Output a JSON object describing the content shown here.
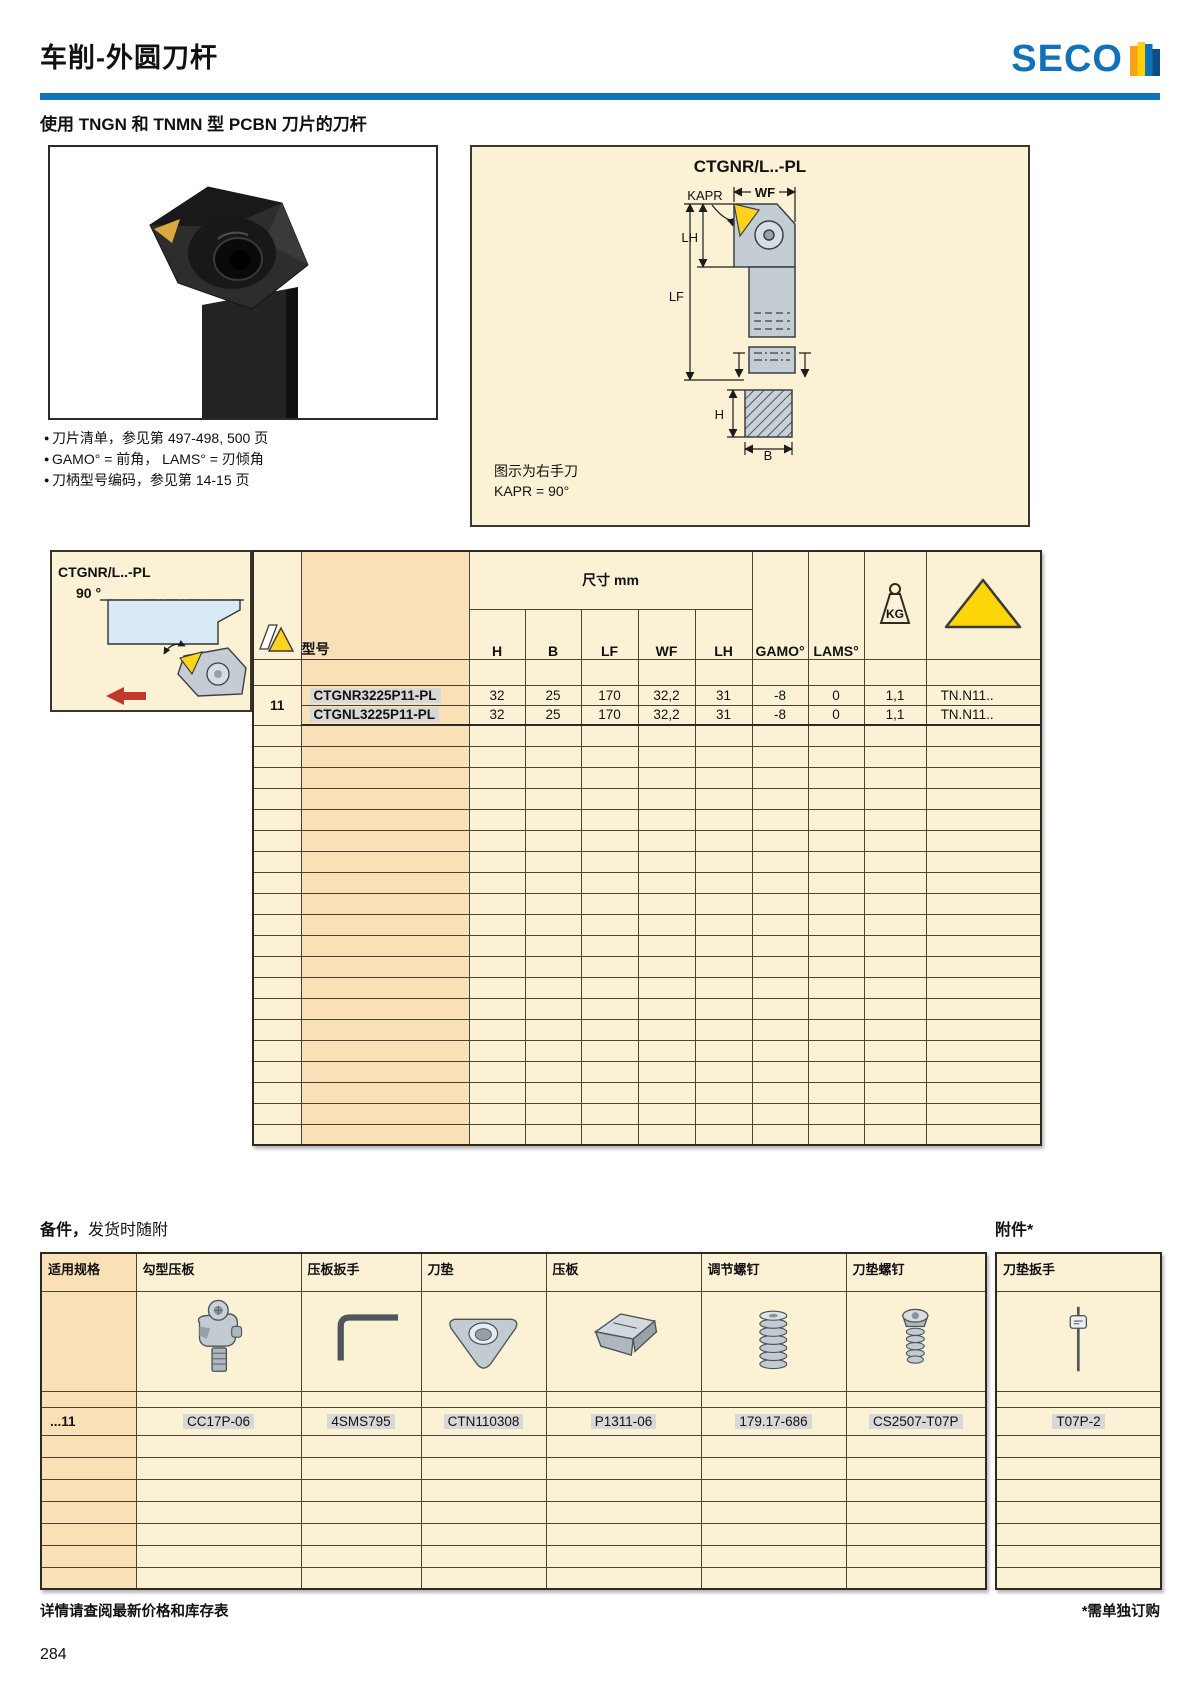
{
  "page": {
    "title": "车削-外圆刀杆",
    "brand": "SECO",
    "page_number": "284"
  },
  "intro": {
    "subtitle": "使用 TNGN 和 TNMN 型 PCBN 刀片的刀杆",
    "bullets": [
      "刀片清单，参见第 497-498, 500 页",
      "GAMO° = 前角， LAMS° = 刃倾角",
      "刀柄型号编码，参见第 14-15 页"
    ]
  },
  "diagram": {
    "title": "CTGNR/L..-PL",
    "note1": "图示为右手刀",
    "note2": "KAPR = 90°",
    "labels": {
      "kapr": "KAPR",
      "wf": "WF",
      "lh": "LH",
      "lf": "LF",
      "h": "H",
      "b": "B"
    }
  },
  "selector_box": {
    "model": "CTGNR/L..-PL",
    "angle": "90 °"
  },
  "main_table": {
    "headers": {
      "model": "型号",
      "dim_group": "尺寸 mm",
      "dims": [
        "H",
        "B",
        "LF",
        "WF",
        "LH"
      ],
      "gamo": "GAMO°",
      "lams": "LAMS°",
      "kg": "KG"
    },
    "rows": [
      {
        "ref": "11",
        "model": "CTGNR3225P11-PL",
        "H": "32",
        "B": "25",
        "LF": "170",
        "WF": "32,2",
        "LH": "31",
        "gamo": "-8",
        "lams": "0",
        "kg": "1,1",
        "insert": "TN.N11.."
      },
      {
        "model": "CTGNL3225P11-PL",
        "H": "32",
        "B": "25",
        "LF": "170",
        "WF": "32,2",
        "LH": "31",
        "gamo": "-8",
        "lams": "0",
        "kg": "1,1",
        "insert": "TN.N11.."
      }
    ]
  },
  "accessories": {
    "included_title_strong": "备件，",
    "included_title_rest": "发货时随附",
    "separate_title": "附件*",
    "headers": [
      "适用规格",
      "勾型压板",
      "压板扳手",
      "刀垫",
      "压板",
      "调节螺钉",
      "刀垫螺钉"
    ],
    "wrench_header": "刀垫扳手",
    "row": {
      "spec": "...11",
      "hook_clamp": "CC17P-06",
      "clamp_wrench": "4SMS795",
      "shim": "CTN110308",
      "clamp": "P1311-06",
      "adjust_screw": "179.17-686",
      "shim_screw": "CS2507-T07P",
      "shim_wrench": "T07P-2"
    }
  },
  "footer": {
    "left": "详情请查阅最新价格和库存表",
    "right": "*需单独订购"
  },
  "colors": {
    "accent_blue": "#1272B9",
    "cream": "#FBF2D6",
    "peach": "#FAE0B6",
    "insert_yellow": "#FFD21E",
    "highlight_gray": "#D8D8D8",
    "arrow_red": "#C0392B"
  }
}
